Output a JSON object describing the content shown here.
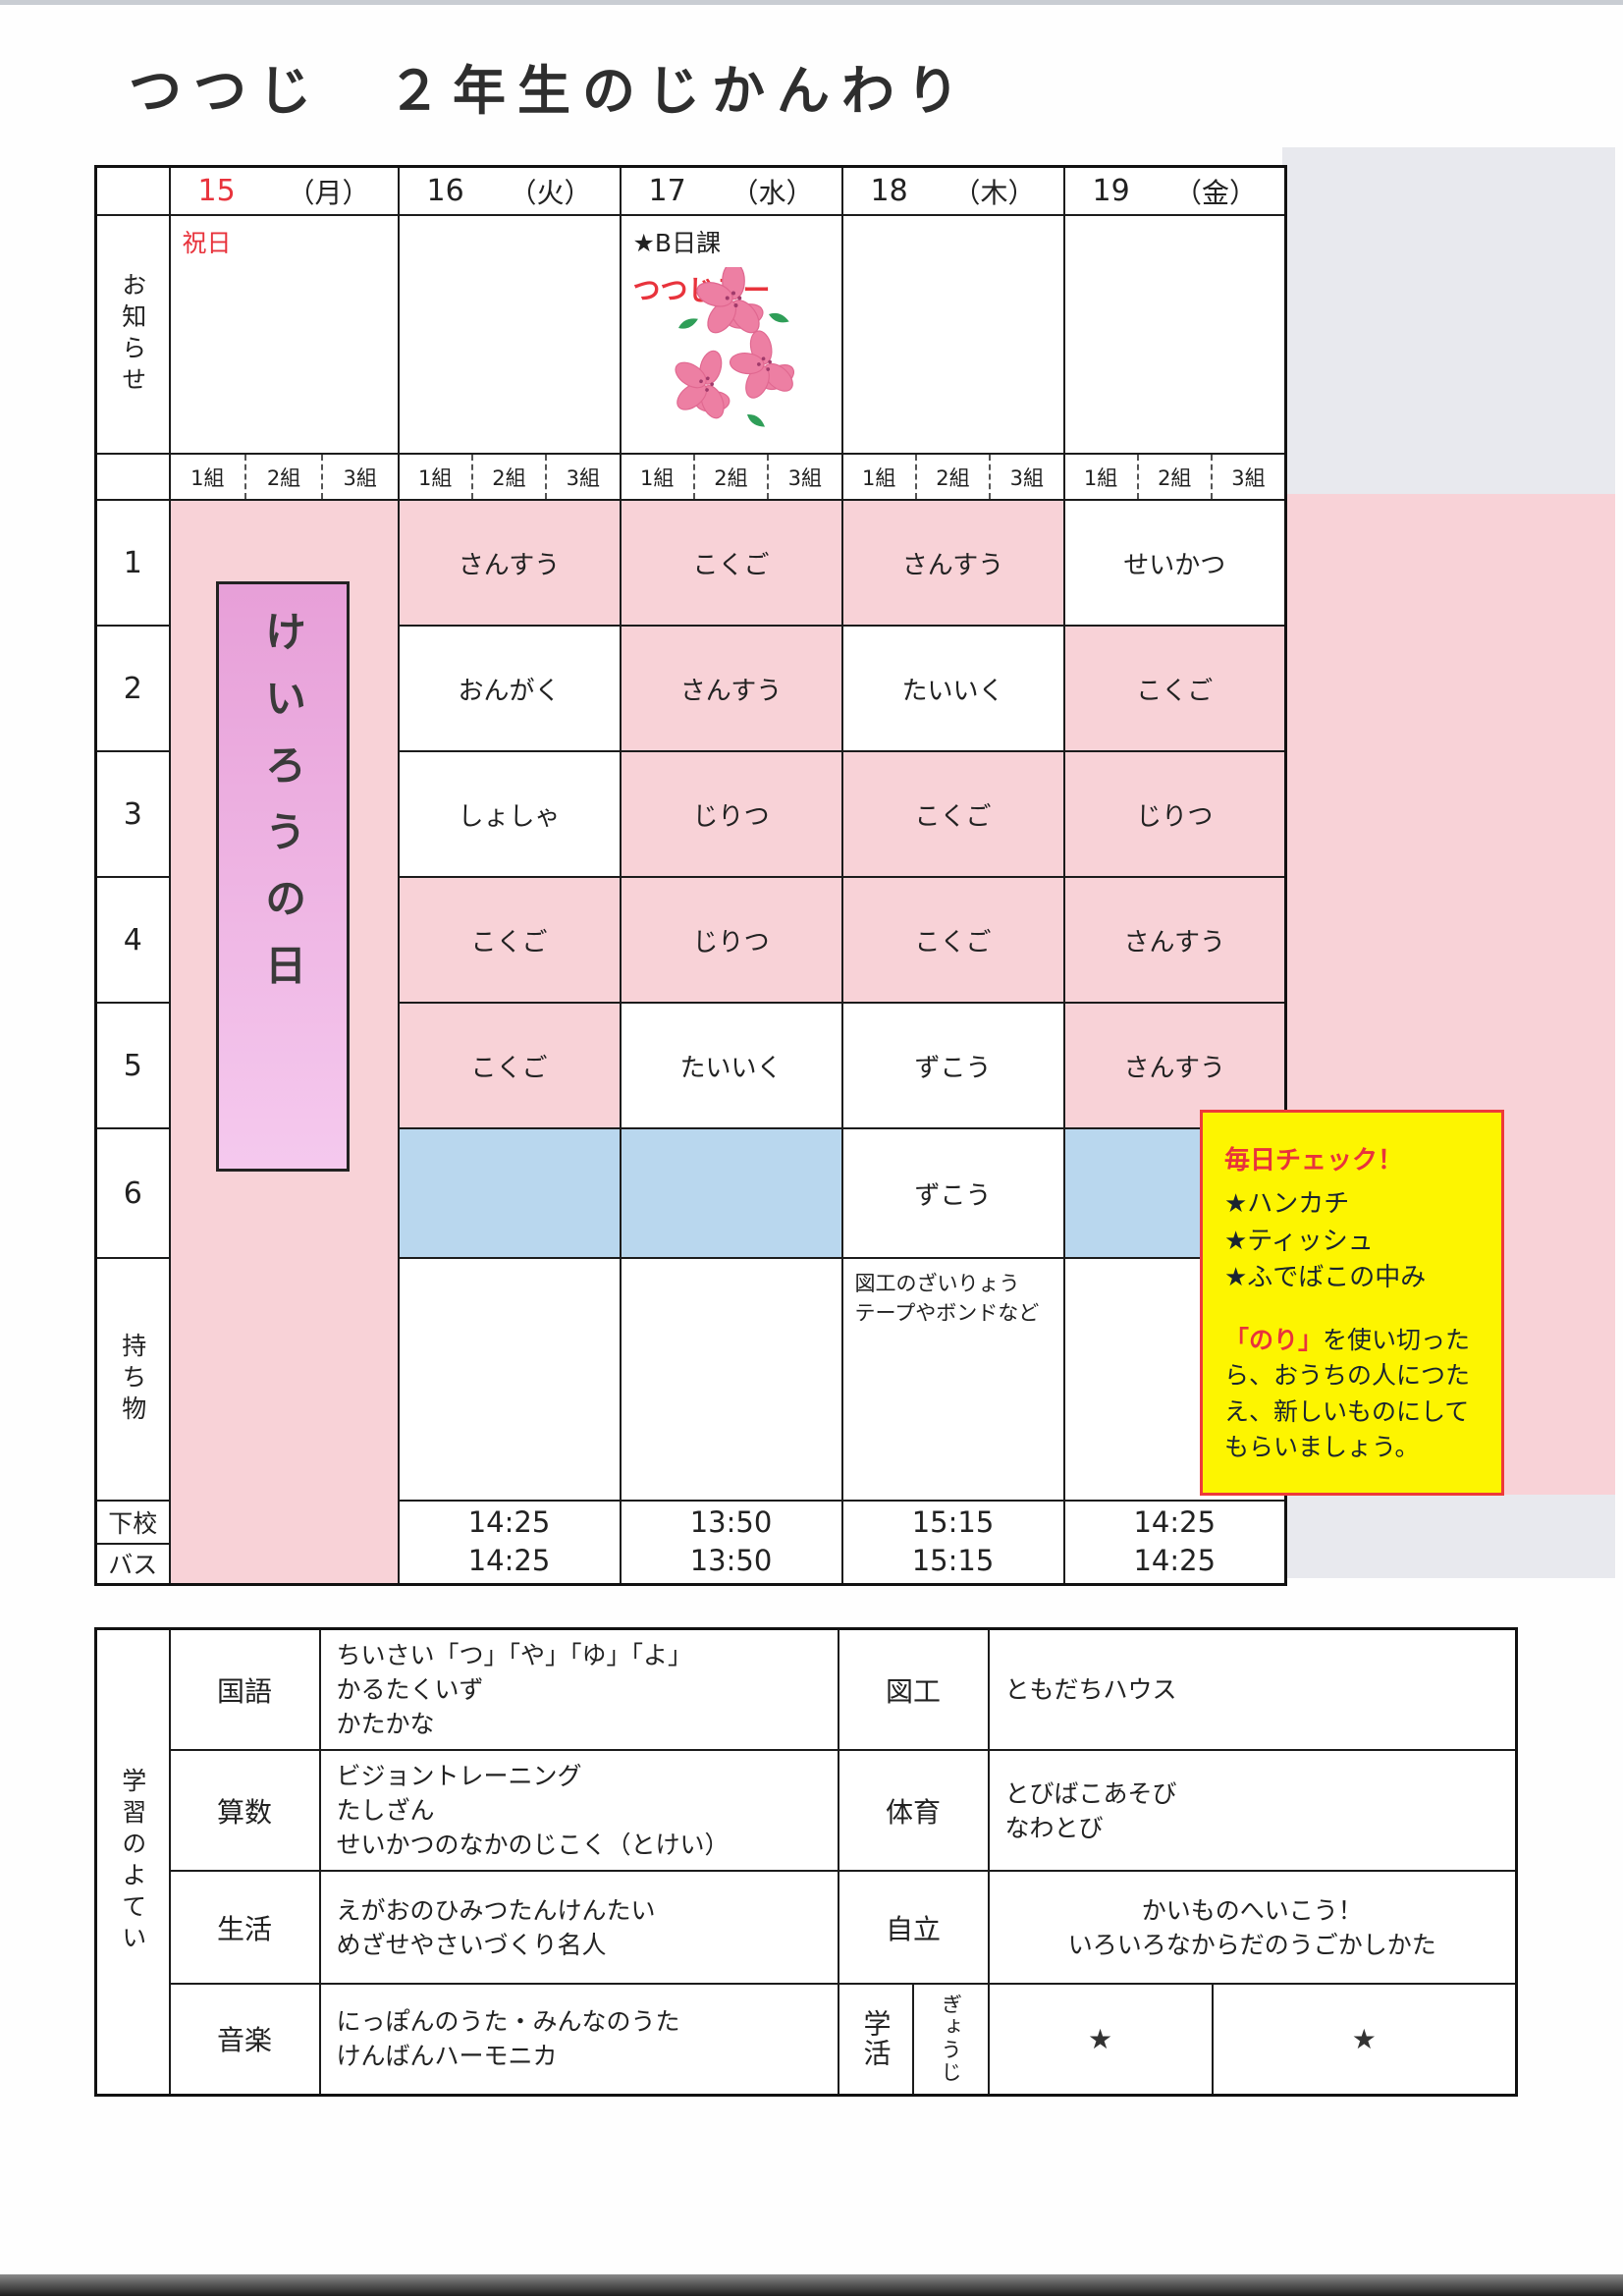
{
  "title": "つつじ　２年生のじかんわり",
  "colors": {
    "cell_pink": "#f8d2d7",
    "cell_blue": "#b9d7ee",
    "margin_gray": "#e8e9ee",
    "note_yellow": "#fdf500",
    "note_border_red": "#ee3a3a",
    "accent_red": "#e8333c",
    "banner_purple": "#e79fd8"
  },
  "week": {
    "days": [
      {
        "date": "15",
        "dow": "（月）"
      },
      {
        "date": "16",
        "dow": "（火）"
      },
      {
        "date": "17",
        "dow": "（水）"
      },
      {
        "date": "18",
        "dow": "（木）"
      },
      {
        "date": "19",
        "dow": "（金）"
      }
    ],
    "groups": [
      "1組",
      "2組",
      "3組"
    ],
    "labels": {
      "announce": "お知らせ",
      "belongings": "持ち物",
      "dismissal": "下校",
      "bus": "バス"
    },
    "period_numbers": [
      "1",
      "2",
      "3",
      "4",
      "5",
      "6"
    ]
  },
  "announcements": {
    "monday_holiday": "祝日",
    "wednesday_line1": "★B日課",
    "wednesday_line2": "つつじデー"
  },
  "monday_banner": "けいろうの日",
  "schedule": {
    "p1": {
      "tue": "さんすう",
      "wed": "こくご",
      "thu": "さんすう",
      "fri": "せいかつ"
    },
    "p2": {
      "tue": "おんがく",
      "wed": "さんすう",
      "thu": "たいいく",
      "fri": "こくご"
    },
    "p3": {
      "tue": "しょしゃ",
      "wed": "じりつ",
      "thu": "こくご",
      "fri": "じりつ"
    },
    "p4": {
      "tue": "こくご",
      "wed": "じりつ",
      "thu": "こくご",
      "fri": "さんすう"
    },
    "p5": {
      "tue": "こくご",
      "wed": "たいいく",
      "thu": "ずこう",
      "fri": "さんすう"
    },
    "p6": {
      "thu": "ずこう"
    }
  },
  "belongings": {
    "thursday": "図工のざいりょう\nテープやボンドなど"
  },
  "times": {
    "dismissal": {
      "tue": "14:25",
      "wed": "13:50",
      "thu": "15:15",
      "fri": "14:25"
    },
    "bus": {
      "tue": "14:25",
      "wed": "13:50",
      "thu": "15:15",
      "fri": "14:25"
    }
  },
  "note": {
    "heading": "毎日チェック！",
    "items": [
      "★ハンカチ",
      "★ティッシュ",
      "★ふでばこの中み"
    ],
    "glue_highlight": "「のり」",
    "glue_rest": "を使い切ったら、おうちの人につたえ、新しいものにしてもらいましょう。"
  },
  "study_plan": {
    "header": "学習のよてい",
    "rows": [
      {
        "left_subject": "国語",
        "left_content": "ちいさい「つ」「や」「ゆ」「よ」\nかるたくいず\nかたかな",
        "right_subject": "図工",
        "right_content": "ともだちハウス"
      },
      {
        "left_subject": "算数",
        "left_content": "ビジョントレーニング\nたしざん\nせいかつのなかのじこく（とけい）",
        "right_subject": "体育",
        "right_content": "とびばこあそび\nなわとび"
      },
      {
        "left_subject": "生活",
        "left_content": "えがおのひみつたんけんたい\nめざせやさいづくり名人",
        "right_subject": "自立",
        "right_content": "かいものへいこう！\nいろいろなからだのうごかしかた"
      },
      {
        "left_subject": "音楽",
        "left_content": "にっぽんのうた・みんなのうた\nけんばんハーモニカ",
        "right_subject": "学活",
        "right_sub_label": "ぎょうじ",
        "star1": "★",
        "star2": "★"
      }
    ]
  }
}
